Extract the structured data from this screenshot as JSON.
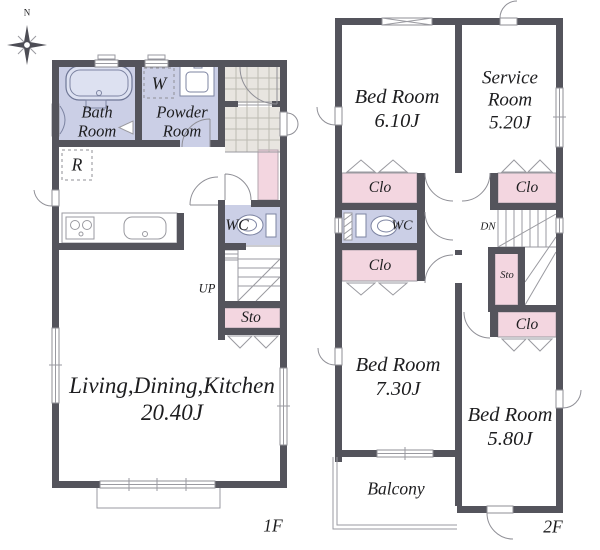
{
  "compass": {
    "north_label": "N"
  },
  "floor1": {
    "floor_label": "1F",
    "bath": {
      "line1": "Bath",
      "line2": "Room"
    },
    "powder": {
      "line1": "Powder",
      "line2": "Room"
    },
    "washer_label": "W",
    "fridge_label": "R",
    "wc_label": "WC",
    "stairs_up_label": "UP",
    "storage_label": "Sto",
    "ldk": {
      "name": "Living,Dining,Kitchen",
      "size": "20.40J"
    }
  },
  "floor2": {
    "floor_label": "2F",
    "bed1": {
      "name": "Bed Room",
      "size": "6.10J"
    },
    "service": {
      "line1": "Service",
      "line2": "Room",
      "size": "5.20J"
    },
    "bed2": {
      "name": "Bed Room",
      "size": "7.30J"
    },
    "bed3": {
      "name": "Bed Room",
      "size": "5.80J"
    },
    "wc_label": "WC",
    "stairs_down_label": "DN",
    "storage_label": "Sto",
    "closet_label": "Clo",
    "balcony_label": "Balcony"
  },
  "colors": {
    "wall": "#54545c",
    "wet": "#cbcfe6",
    "closet": "#f3d6e0",
    "tile": "#e8e5e0",
    "text": "#1d1d1f"
  }
}
